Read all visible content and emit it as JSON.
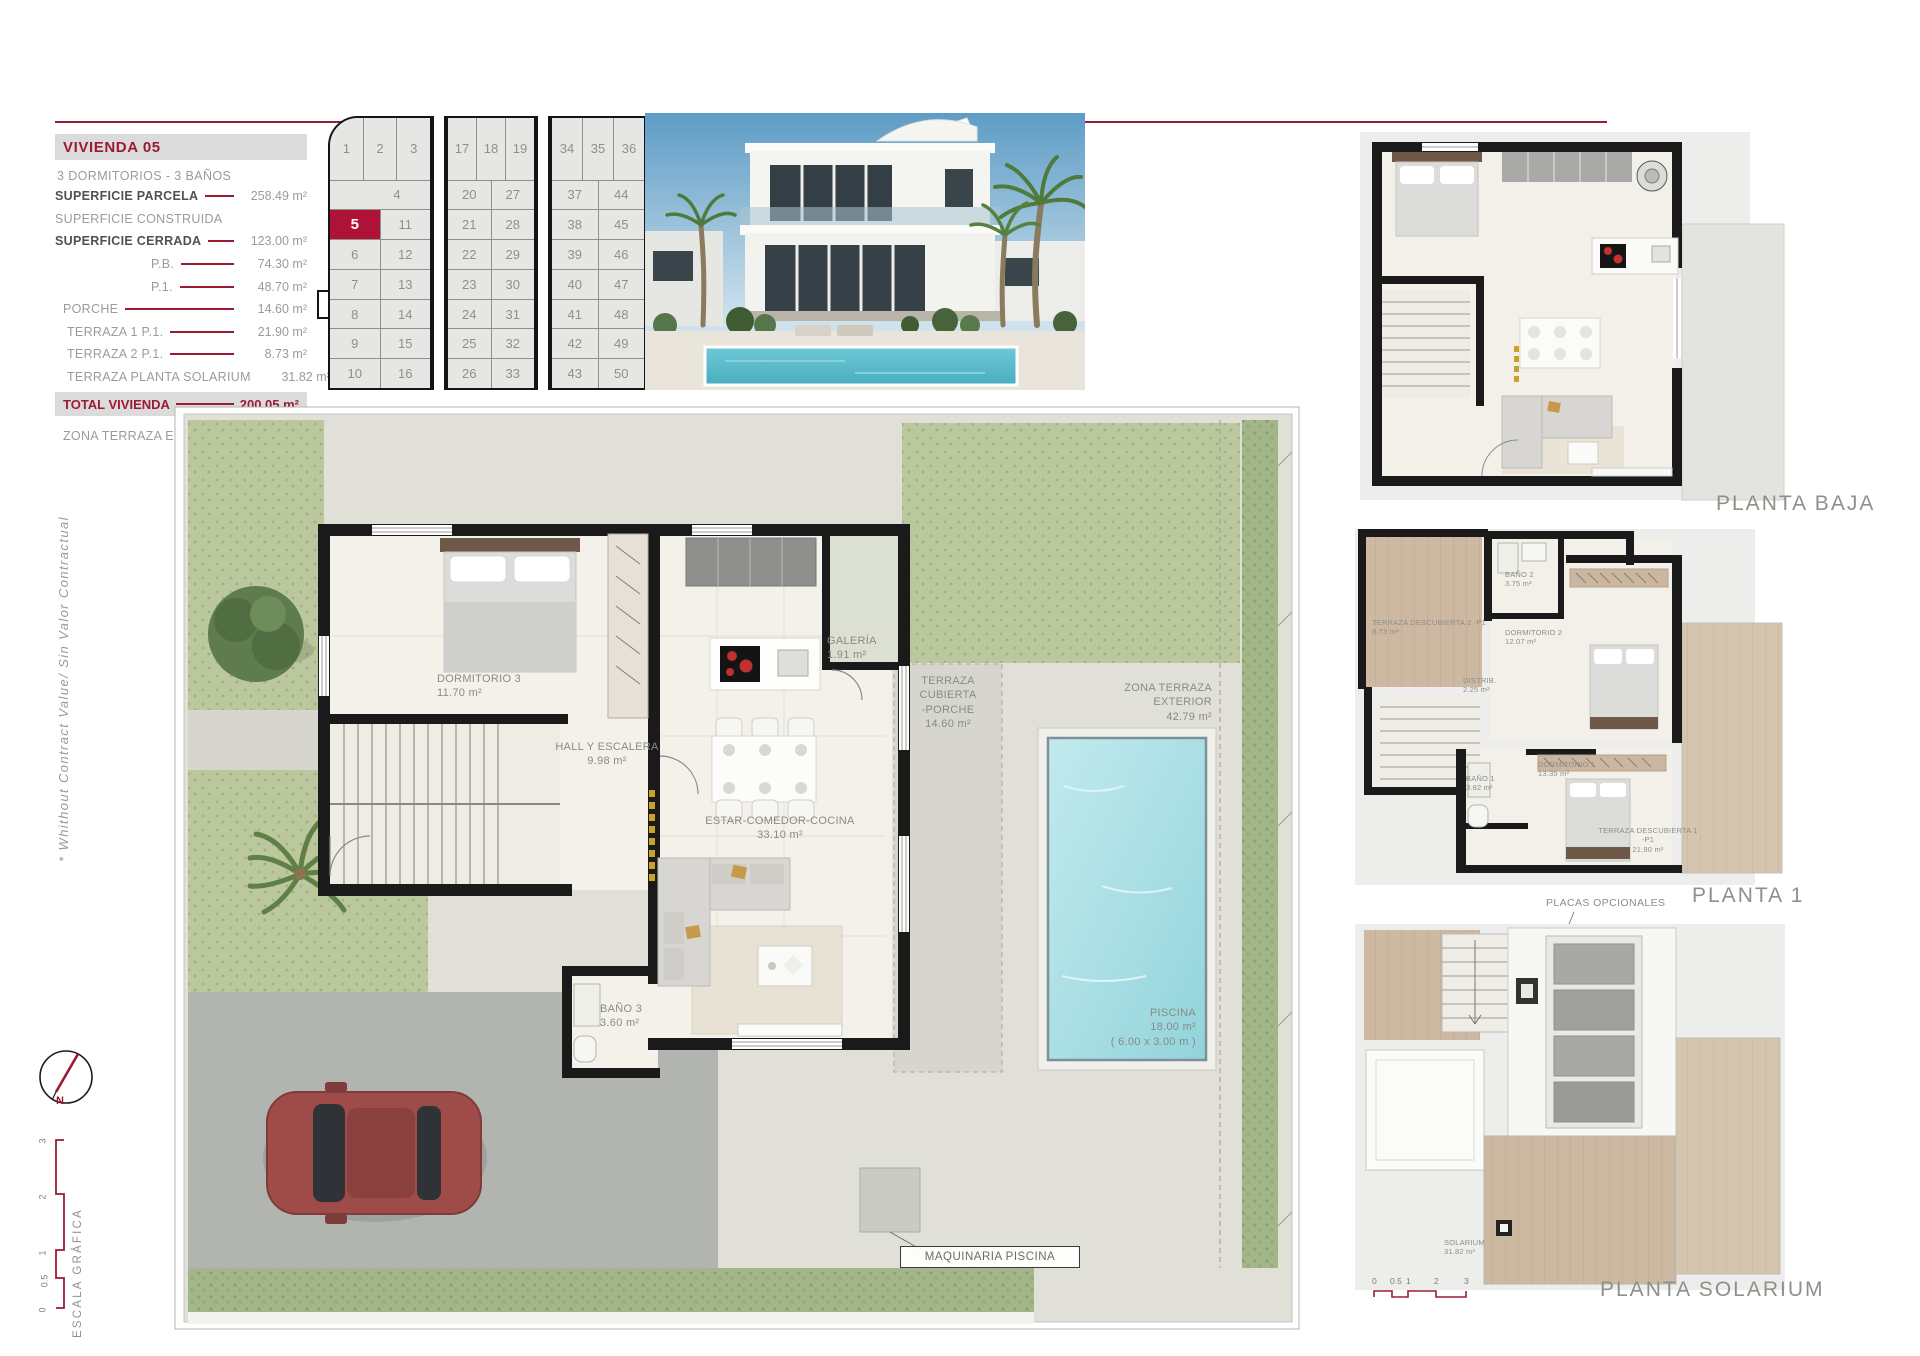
{
  "colors": {
    "accent": "#9B1B35",
    "plot_red": "#AE1236"
  },
  "info_panel": {
    "title": "VIVIENDA 05",
    "subtitle": "3 DORMITORIOS - 3 BAÑOS",
    "rows": [
      {
        "label": "SUPERFICIE PARCELA",
        "value": "258.49 m²"
      },
      {
        "label": "SUPERFICIE CONSTRUIDA",
        "value": ""
      },
      {
        "label": "SUPERFICIE CERRADA",
        "value": "123.00 m²"
      },
      {
        "label": "P.B.",
        "value": "74.30 m²"
      },
      {
        "label": "P.1.",
        "value": "48.70 m²"
      },
      {
        "label": "PORCHE",
        "value": "14.60 m²"
      },
      {
        "label": "TERRAZA 1 P.1.",
        "value": "21.90 m²"
      },
      {
        "label": "TERRAZA 2 P.1.",
        "value": "8.73 m²"
      },
      {
        "label": "TERRAZA PLANTA SOLARIUM",
        "value": "31.82 m²"
      }
    ],
    "total": {
      "label": "TOTAL VIVIENDA",
      "value": "200.05 m²"
    },
    "zona": {
      "label": "ZONA TERRAZA EXTERIOR",
      "value": "42.79 m²"
    }
  },
  "site_plan": {
    "highlighted": "5",
    "strips": [
      {
        "top": [
          "1",
          "2",
          "3"
        ],
        "rows": [
          [
            "4"
          ],
          [
            "5",
            "11"
          ],
          [
            "6",
            "12"
          ],
          [
            "7",
            "13"
          ],
          [
            "8",
            "14"
          ],
          [
            "9",
            "15"
          ],
          [
            "10",
            "16"
          ]
        ]
      },
      {
        "top": [
          "17",
          "18",
          "19"
        ],
        "rows": [
          [
            "20",
            "27"
          ],
          [
            "21",
            "28"
          ],
          [
            "22",
            "29"
          ],
          [
            "23",
            "30"
          ],
          [
            "24",
            "31"
          ],
          [
            "25",
            "32"
          ],
          [
            "26",
            "33"
          ]
        ]
      },
      {
        "top": [
          "34",
          "35",
          "36"
        ],
        "rows": [
          [
            "37",
            "44"
          ],
          [
            "38",
            "45"
          ],
          [
            "39",
            "46"
          ],
          [
            "40",
            "47"
          ],
          [
            "41",
            "48"
          ],
          [
            "42",
            "49"
          ],
          [
            "43",
            "50"
          ]
        ]
      }
    ]
  },
  "main_plan": {
    "rooms": [
      {
        "name": "DORMITORIO 3",
        "area": "11.70 m²"
      },
      {
        "name": "GALERÍA",
        "area": "1.91 m²"
      },
      {
        "name": "HALL Y ESCALERA",
        "area": "9.98 m²"
      },
      {
        "name": "ESTAR-COMEDOR-COCINA",
        "area": "33.10 m²"
      },
      {
        "name": "TERRAZA CUBIERTA",
        "name2": "-PORCHE",
        "area": "14.60 m²"
      },
      {
        "name": "ZONA TERRAZA EXTERIOR",
        "area": "42.79 m²"
      },
      {
        "name": "BAÑO 3",
        "area": "3.60 m²"
      },
      {
        "name": "PISCINA",
        "area": "18.00 m²",
        "dims": "( 6.00 x 3.00 m )"
      }
    ],
    "maquinaria_label": "MAQUINARIA PISCINA"
  },
  "floor_plans": {
    "planta_baja": {
      "label": "PLANTA BAJA"
    },
    "planta_1": {
      "label": "PLANTA 1",
      "annotation": "PLACAS OPCIONALES",
      "rooms": [
        {
          "name": "TERRAZA DESCUBIERTA 2 -P1",
          "area": "8.73 m²"
        },
        {
          "name": "BAÑO 2",
          "area": "3.75 m²"
        },
        {
          "name": "DORMITORIO 2",
          "area": "12.07 m²"
        },
        {
          "name": "DISTRIB.",
          "area": "2.25 m²"
        },
        {
          "name": "BAÑO 1",
          "area": "3.82 m²"
        },
        {
          "name": "DORMITORIO 1",
          "area": "13.35 m²"
        },
        {
          "name": "TERRAZA DESCUBIERTA 1 -P1",
          "area": "21.90 m²"
        }
      ]
    },
    "planta_solarium": {
      "label": "PLANTA SOLARIUM",
      "rooms": [
        {
          "name": "SOLARIUM",
          "area": "31.82 m²"
        }
      ],
      "scale_ticks": [
        "0",
        "0.5",
        "1",
        "2",
        "3"
      ]
    }
  },
  "side_notes": {
    "disclaimer": "*  Whithout Contract Value/ Sin Valor Contractual",
    "compass_label": "N",
    "scale_label": "ESCALA GRÁFICA",
    "scale_ticks": [
      "0",
      "0.5",
      "1",
      "2",
      "3"
    ]
  }
}
